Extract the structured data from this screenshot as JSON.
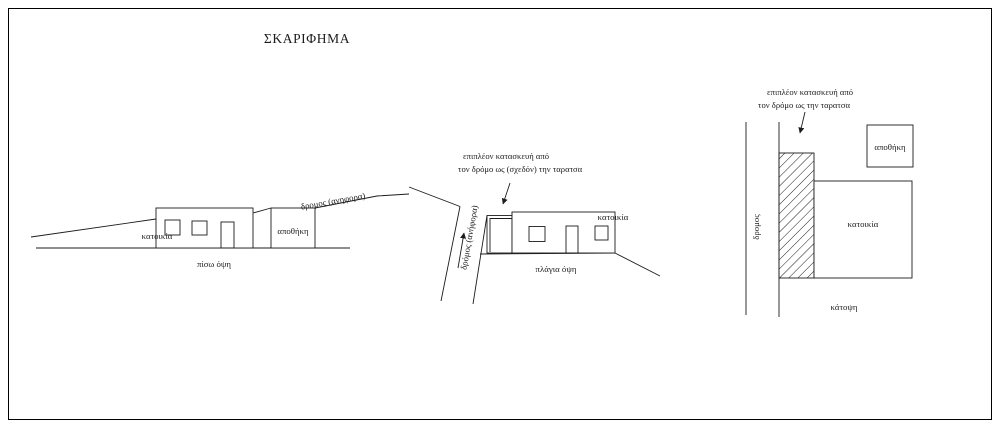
{
  "title": "ΣΚΑΡΙΦΗΜΑ",
  "colors": {
    "ink": "#1c1c1c",
    "background": "#ffffff",
    "border": "#000000"
  },
  "views": {
    "rear": {
      "name": "πίσω όψη",
      "labels": {
        "house": "κατοικία",
        "storage": "αποθήκη",
        "road": "δρομος (ανηφορα)"
      }
    },
    "side": {
      "name": "πλάγια όψη",
      "labels": {
        "house": "κατοικία",
        "road": "δρόμος (ανήφορα)"
      },
      "annotation": {
        "line1": "επιπλέον κατασκευή από",
        "line2": "τον δρόμο ως (σχεδόν) την ταρατσα"
      }
    },
    "plan": {
      "name": "κάτοψη",
      "labels": {
        "house": "κατοικία",
        "storage": "αποθήκη",
        "road": "δρομος"
      },
      "annotation": {
        "line1": "επιπλέον κατασκευή από",
        "line2": "τον δρόμο ως  την ταρατσα"
      }
    }
  }
}
